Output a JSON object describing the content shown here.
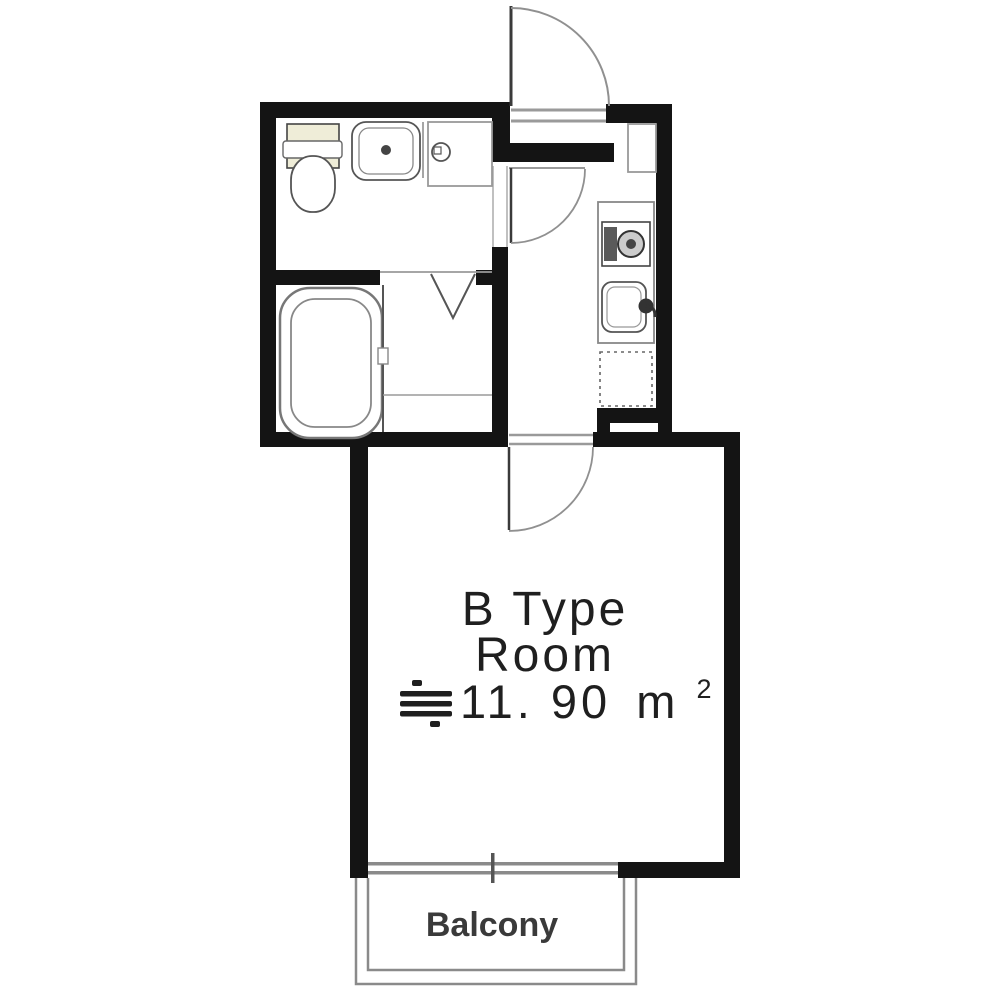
{
  "plan": {
    "type": "apartment-floor-plan",
    "rooms": {
      "main_room": {
        "label_line1": "B Type",
        "label_line2": "Room",
        "area_approx_symbol": "≒",
        "area_value": "11. 90",
        "area_unit_base": "m",
        "area_unit_exponent": "2"
      },
      "balcony": {
        "label": "Balcony"
      }
    },
    "fixtures": [
      "entrance-door-arc-icon",
      "hall-door-arc-icon",
      "room-door-arc-icon",
      "toilet-icon",
      "washbasin-icon",
      "washing-machine-pan-icon",
      "bathtub-icon",
      "folding-door-icon",
      "shoe-cabinet-icon",
      "stove-icon",
      "kitchen-sink-icon",
      "refrigerator-space-icon",
      "balcony-window-icon"
    ],
    "colors": {
      "background": "#ffffff",
      "wall": "#141414",
      "fixture_outline": "#777777",
      "door_arc": "#909090",
      "window_line": "#8a8a8a",
      "text": "#1f1f1f",
      "balcony_text": "#3a3a3a",
      "toilet_tank_fill": "#efedd8",
      "stove_pad_fill": "#5a5a5a"
    }
  }
}
